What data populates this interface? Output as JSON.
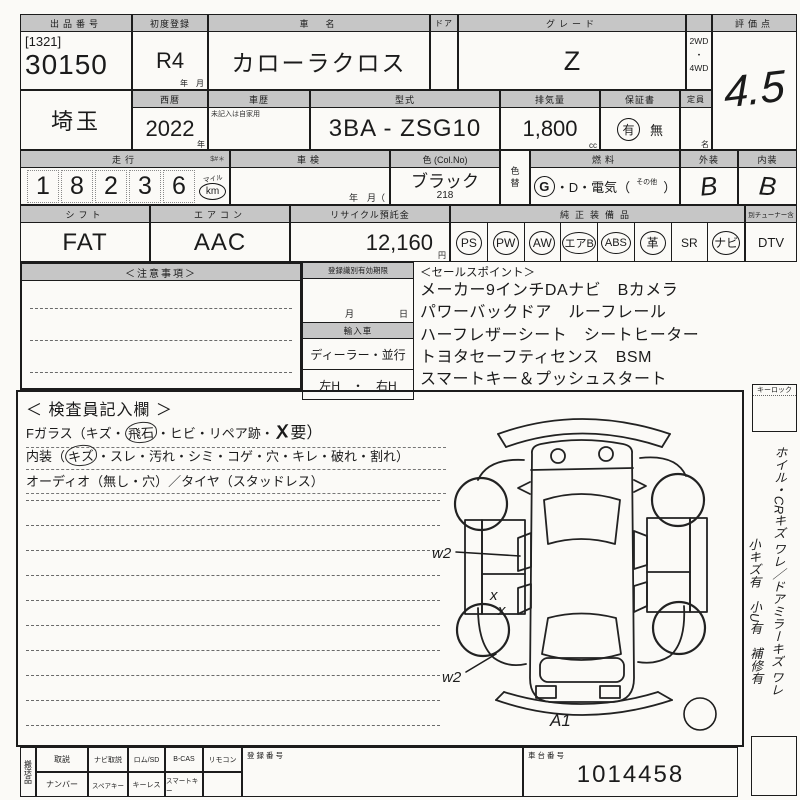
{
  "doc": {
    "auction": {
      "label": "出品番号",
      "bracket": "[1321]",
      "number": "30150"
    },
    "first_reg": {
      "label": "初度登録",
      "value": "R4",
      "units": "年　月"
    },
    "car_name": {
      "label": "車　名",
      "value": "カローラクロス"
    },
    "door": {
      "label": "ドア"
    },
    "grade": {
      "label": "グレード",
      "value": "Z"
    },
    "drive": {
      "label": "駆動",
      "top": "2WD",
      "dot": "・",
      "bottom": "4WD"
    },
    "score": {
      "label": "評価点",
      "value": "4.5"
    },
    "region": {
      "value": "埼玉"
    },
    "year": {
      "label": "西暦",
      "value": "2022",
      "unit": "年"
    },
    "history": {
      "label": "車歴",
      "note": "未記入は自家用"
    },
    "model": {
      "label": "型式",
      "value": "3BA - ZSG10"
    },
    "displacement": {
      "label": "排気量",
      "value": "1,800",
      "unit": "cc"
    },
    "warranty": {
      "label": "保証書",
      "yes": "有",
      "no": "無"
    },
    "capacity": {
      "label": "定員",
      "unit": "名"
    },
    "mileage": {
      "label": "走行",
      "note": "$#＊",
      "digits": [
        "1",
        "8",
        "2",
        "3",
        "6"
      ],
      "unit_top": "マイル",
      "unit": "km"
    },
    "inspection": {
      "label": "車検",
      "units": "年　月（"
    },
    "color": {
      "label": "色 (Col.No)",
      "value": "ブラック",
      "code": "218"
    },
    "color_change": {
      "top": "色",
      "bottom": "替"
    },
    "fuel": {
      "label": "燃料",
      "g": "G",
      "mid": "・D・電気（",
      "other": "その他",
      "close": "）"
    },
    "exterior": {
      "label": "外装",
      "value": "B"
    },
    "interior": {
      "label": "内装",
      "value": "B"
    },
    "shift": {
      "label": "シフト",
      "value": "FAT"
    },
    "aircon": {
      "label": "エアコン",
      "value": "AAC"
    },
    "recycle": {
      "label": "リサイクル預託金",
      "value": "12,160",
      "unit": "円"
    },
    "equipment": {
      "label": "純正装備品",
      "items": [
        {
          "label": "PS",
          "circled": true
        },
        {
          "label": "PW",
          "circled": true
        },
        {
          "label": "AW",
          "circled": true
        },
        {
          "label": "エアB",
          "circled": true
        },
        {
          "label": "ABS",
          "circled": true
        },
        {
          "label": "革",
          "circled": true
        },
        {
          "label": "SR",
          "circled": false
        },
        {
          "label": "ナビ",
          "circled": true
        }
      ],
      "dtv_label": "DTV",
      "dtv_note": "別チューナー含"
    }
  },
  "notes": {
    "label": "＜注意事項＞"
  },
  "regbox": {
    "expiry_label": "登録識別有効期限",
    "month": "月",
    "day": "日",
    "import_label": "輸入車",
    "dealer": "ディーラー・並行",
    "handle": "左H　・　右H"
  },
  "salespoints": {
    "label": "＜セールスポイント＞",
    "lines": [
      "メーカー9インチDAナビ　Bカメラ",
      "パワーバックドア　ルーフレール",
      "ハーフレザーシート　シートヒーター",
      "トヨタセーフティセンス　BSM",
      "スマートキー＆プッシュスタート"
    ]
  },
  "inspector": {
    "title": "＜ 検査員記入欄 ＞",
    "fglass_prefix": "Fガラス（キズ・",
    "fglass_circled": "飛石",
    "fglass_mid": "・ヒビ・リペア跡・",
    "fglass_mark": "X",
    "fglass_suffix": "要）",
    "interior_prefix": "内装（",
    "interior_circled": "キズ",
    "interior_suffix": "・スレ・汚れ・シミ・コゲ・穴・キレ・破れ・割れ）",
    "audio": "オーディオ（無し・穴）／タイヤ（スタッドレス）"
  },
  "diagram": {
    "w2_front": "w2",
    "x_upper": "x",
    "x_lower": "x",
    "w2_rear": "w2",
    "a1": "A1"
  },
  "side": {
    "keylock": "キーロック",
    "memo1": "ホイル・CRキズ ワレ／ドアミラーキズ ワレ",
    "memo2": "小キズ有　小U有　補修有"
  },
  "bottom": {
    "carry": "搬送品",
    "row1": [
      "取説",
      "ナビ取説",
      "ロム/SD",
      "B-CAS",
      "リモコン"
    ],
    "row2": [
      "ナンバー",
      "スペアキー",
      "キーレス",
      "スマートキー"
    ],
    "reg_no_label": "登録番号",
    "chassis_label": "車台番号",
    "chassis_no": "1014458"
  }
}
